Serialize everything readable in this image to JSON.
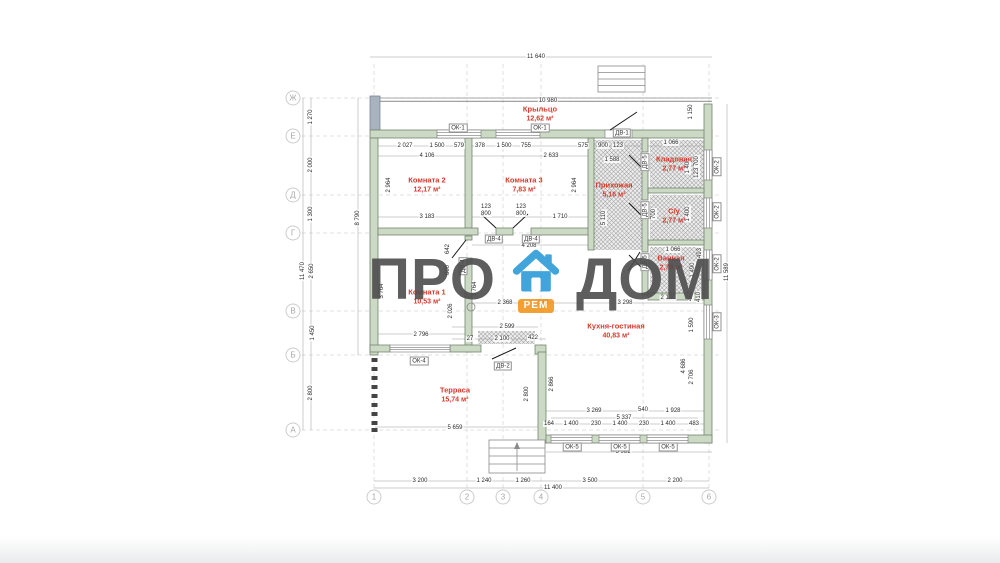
{
  "watermark": {
    "pro": "ПРО",
    "dom": "ДОМ",
    "badge": "РЕМ"
  },
  "colors": {
    "room_label": "#d8382c",
    "wall_fill": "#ccd9c5",
    "watermark_gray": "#4d4d4d",
    "house_icon_blue": "#2d9cd8",
    "badge_orange": "#f2961f"
  },
  "rooms": [
    {
      "name": "Крыльцо",
      "area": "12,62 м²",
      "x": 540,
      "y": 114
    },
    {
      "name": "Комната 2",
      "area": "12,17 м²",
      "x": 427,
      "y": 185
    },
    {
      "name": "Комната 3",
      "area": "7,83 м²",
      "x": 524,
      "y": 185
    },
    {
      "name": "Прихожая",
      "area": "5,16 м²",
      "x": 614,
      "y": 190
    },
    {
      "name": "Кладовая",
      "area": "2,77 м²",
      "x": 674,
      "y": 164
    },
    {
      "name": "С/у",
      "area": "2,77 м²",
      "x": 674,
      "y": 216
    },
    {
      "name": "Ванная",
      "area": "2,79 м²",
      "x": 671,
      "y": 263
    },
    {
      "name": "Комната 1",
      "area": "10,53 м²",
      "x": 427,
      "y": 297
    },
    {
      "name": "Кухня-гостиная",
      "area": "40,83 м²",
      "x": 616,
      "y": 331
    },
    {
      "name": "Терраса",
      "area": "15,74 м²",
      "x": 455,
      "y": 395
    }
  ],
  "openings": [
    {
      "t": "ОК-1",
      "x": 458,
      "y": 128
    },
    {
      "t": "ОК-1",
      "x": 540,
      "y": 128
    },
    {
      "t": "ДВ-1",
      "x": 622,
      "y": 133
    },
    {
      "t": "ОК-2",
      "x": 717,
      "y": 167,
      "v": 1
    },
    {
      "t": "ОК-2",
      "x": 717,
      "y": 212,
      "v": 1
    },
    {
      "t": "ОК-2",
      "x": 717,
      "y": 264,
      "v": 1
    },
    {
      "t": "ОК-3",
      "x": 717,
      "y": 322,
      "v": 1
    },
    {
      "t": "ДВ-4",
      "x": 494,
      "y": 239
    },
    {
      "t": "ДВ-4",
      "x": 531,
      "y": 239
    },
    {
      "t": "ДВ-4",
      "x": 463,
      "y": 266,
      "v": 1
    },
    {
      "t": "ДВ-5",
      "x": 645,
      "y": 162,
      "v": 1
    },
    {
      "t": "ДВ-5",
      "x": 645,
      "y": 210,
      "v": 1
    },
    {
      "t": "ДВ-5",
      "x": 645,
      "y": 262,
      "v": 1
    },
    {
      "t": "ДВ-2",
      "x": 503,
      "y": 366
    },
    {
      "t": "ОК-4",
      "x": 419,
      "y": 361
    },
    {
      "t": "ОК-5",
      "x": 572,
      "y": 447
    },
    {
      "t": "ОК-5",
      "x": 620,
      "y": 447
    },
    {
      "t": "ОК-5",
      "x": 668,
      "y": 447
    }
  ],
  "dims": [
    {
      "t": "11 640",
      "x": 536,
      "y": 57
    },
    {
      "t": "10 980",
      "x": 548,
      "y": 101
    },
    {
      "t": "1 150",
      "x": 691,
      "y": 112,
      "v": 1
    },
    {
      "t": "11 589",
      "x": 727,
      "y": 272,
      "v": 1
    },
    {
      "t": "11 470",
      "x": 303,
      "y": 271,
      "v": 1
    },
    {
      "t": "8 790",
      "x": 358,
      "y": 218,
      "v": 1
    },
    {
      "t": "1 270",
      "x": 311,
      "y": 117,
      "v": 1
    },
    {
      "t": "2 000",
      "x": 311,
      "y": 165,
      "v": 1
    },
    {
      "t": "1 300",
      "x": 311,
      "y": 214,
      "v": 1
    },
    {
      "t": "2 650",
      "x": 312,
      "y": 271,
      "v": 1
    },
    {
      "t": "1 450",
      "x": 313,
      "y": 333,
      "v": 1
    },
    {
      "t": "2 800",
      "x": 311,
      "y": 393,
      "v": 1
    },
    {
      "t": "2 027",
      "x": 405,
      "y": 146
    },
    {
      "t": "1 500",
      "x": 437,
      "y": 146
    },
    {
      "t": "579",
      "x": 459,
      "y": 146
    },
    {
      "t": "378",
      "x": 480,
      "y": 146
    },
    {
      "t": "1 500",
      "x": 504,
      "y": 146
    },
    {
      "t": "755",
      "x": 526,
      "y": 146
    },
    {
      "t": "575",
      "x": 583,
      "y": 146
    },
    {
      "t": "900",
      "x": 603,
      "y": 146
    },
    {
      "t": "123",
      "x": 618,
      "y": 146
    },
    {
      "t": "4 106",
      "x": 427,
      "y": 156
    },
    {
      "t": "2 633",
      "x": 551,
      "y": 156
    },
    {
      "t": "1 588",
      "x": 612,
      "y": 160
    },
    {
      "t": "1 066",
      "x": 671,
      "y": 143
    },
    {
      "t": "2 964",
      "x": 389,
      "y": 185,
      "v": 1
    },
    {
      "t": "2 964",
      "x": 575,
      "y": 185,
      "v": 1
    },
    {
      "t": "5 110",
      "x": 604,
      "y": 218,
      "v": 1
    },
    {
      "t": "1 400",
      "x": 688,
      "y": 166,
      "v": 1
    },
    {
      "t": "123 700",
      "x": 697,
      "y": 167,
      "v": 1
    },
    {
      "t": "1 400",
      "x": 688,
      "y": 214,
      "v": 1
    },
    {
      "t": "700",
      "x": 654,
      "y": 214,
      "v": 1
    },
    {
      "t": "1 066",
      "x": 673,
      "y": 250
    },
    {
      "t": "1 490",
      "x": 693,
      "y": 270,
      "v": 1
    },
    {
      "t": "493",
      "x": 700,
      "y": 253,
      "v": 1
    },
    {
      "t": "3 183",
      "x": 427,
      "y": 217
    },
    {
      "t": "123",
      "x": 486,
      "y": 207
    },
    {
      "t": "800",
      "x": 486,
      "y": 214
    },
    {
      "t": "123",
      "x": 521,
      "y": 207
    },
    {
      "t": "800",
      "x": 521,
      "y": 214
    },
    {
      "t": "1 710",
      "x": 560,
      "y": 217
    },
    {
      "t": "4 208",
      "x": 529,
      "y": 246
    },
    {
      "t": "642",
      "x": 448,
      "y": 249,
      "v": 1
    },
    {
      "t": "800",
      "x": 448,
      "y": 270,
      "v": 1
    },
    {
      "t": "3 764",
      "x": 382,
      "y": 291,
      "v": 1
    },
    {
      "t": "3 764",
      "x": 475,
      "y": 289,
      "v": 1
    },
    {
      "t": "2 026",
      "x": 451,
      "y": 311,
      "v": 1
    },
    {
      "t": "2 796",
      "x": 421,
      "y": 335
    },
    {
      "t": "2 599",
      "x": 507,
      "y": 327
    },
    {
      "t": "27",
      "x": 470,
      "y": 339
    },
    {
      "t": "2 100",
      "x": 502,
      "y": 339
    },
    {
      "t": "422",
      "x": 533,
      "y": 338
    },
    {
      "t": "2 368",
      "x": 505,
      "y": 303
    },
    {
      "t": "540",
      "x": 543,
      "y": 303
    },
    {
      "t": "3 298",
      "x": 625,
      "y": 303
    },
    {
      "t": "2 130",
      "x": 668,
      "y": 298
    },
    {
      "t": "460",
      "x": 691,
      "y": 296,
      "v": 1
    },
    {
      "t": "410",
      "x": 699,
      "y": 297,
      "v": 1
    },
    {
      "t": "1 590",
      "x": 692,
      "y": 325,
      "v": 1
    },
    {
      "t": "4 686",
      "x": 684,
      "y": 366,
      "v": 1
    },
    {
      "t": "2 706",
      "x": 692,
      "y": 377,
      "v": 1
    },
    {
      "t": "2 800",
      "x": 527,
      "y": 394,
      "v": 1
    },
    {
      "t": "2 866",
      "x": 552,
      "y": 384,
      "v": 1
    },
    {
      "t": "5 659",
      "x": 455,
      "y": 428
    },
    {
      "t": "3 269",
      "x": 594,
      "y": 411
    },
    {
      "t": "540",
      "x": 643,
      "y": 410
    },
    {
      "t": "1 928",
      "x": 673,
      "y": 411
    },
    {
      "t": "5 337",
      "x": 624,
      "y": 418
    },
    {
      "t": "164",
      "x": 549,
      "y": 424
    },
    {
      "t": "1 400",
      "x": 571,
      "y": 424
    },
    {
      "t": "230",
      "x": 596,
      "y": 424
    },
    {
      "t": "1 400",
      "x": 620,
      "y": 424
    },
    {
      "t": "230",
      "x": 644,
      "y": 424
    },
    {
      "t": "1 400",
      "x": 668,
      "y": 424
    },
    {
      "t": "483",
      "x": 694,
      "y": 424
    },
    {
      "t": "5 981",
      "x": 623,
      "y": 452
    },
    {
      "t": "3 200",
      "x": 420,
      "y": 481
    },
    {
      "t": "1 240",
      "x": 484,
      "y": 481
    },
    {
      "t": "1 260",
      "x": 523,
      "y": 481
    },
    {
      "t": "3 500",
      "x": 590,
      "y": 481
    },
    {
      "t": "2 200",
      "x": 675,
      "y": 481
    },
    {
      "t": "11 400",
      "x": 553,
      "y": 488
    }
  ],
  "axes": {
    "left_x": 293,
    "bottom_y": 497,
    "left": [
      {
        "t": "Ж",
        "y": 98
      },
      {
        "t": "Е",
        "y": 136
      },
      {
        "t": "Д",
        "y": 195
      },
      {
        "t": "Г",
        "y": 233
      },
      {
        "t": "В",
        "y": 311
      },
      {
        "t": "Б",
        "y": 355
      },
      {
        "t": "А",
        "y": 430
      }
    ],
    "bottom": [
      {
        "t": "1",
        "x": 374
      },
      {
        "t": "2",
        "x": 467
      },
      {
        "t": "3",
        "x": 503
      },
      {
        "t": "4",
        "x": 541
      },
      {
        "t": "5",
        "x": 643
      },
      {
        "t": "6",
        "x": 709
      }
    ]
  }
}
